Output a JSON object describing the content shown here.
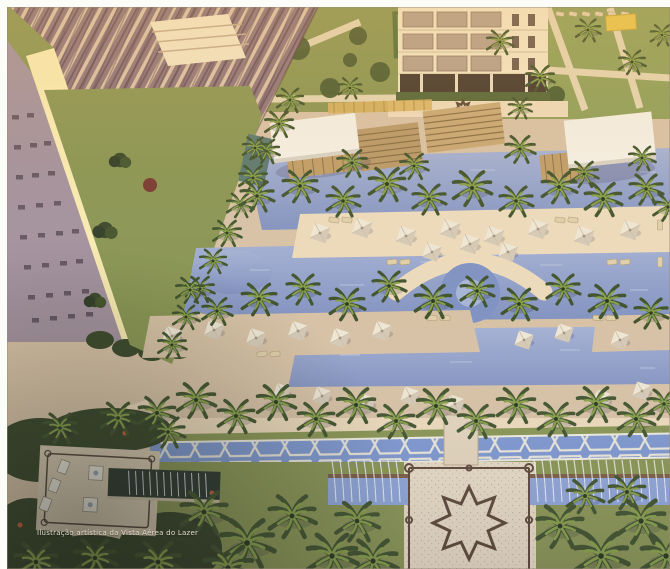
{
  "image": {
    "kind": "aerial architectural rendering of a residential leisure area at dusk",
    "caption": "Ilustração artística da Vista Aérea do Lazer"
  },
  "palette": {
    "frame": "#fcfcf9",
    "deck": "#d7c2a6",
    "deck_light": "#ecdabb",
    "water": "#94a2c8",
    "water_light": "#b6c0da",
    "canal": "#7e98cf",
    "dark_pool": "#2e3a30",
    "grass": "#8a9655",
    "grass_dark": "#55663a",
    "palm_dark": "#42552f",
    "palm_light": "#88a04b",
    "building_cream": "#f1e4c4",
    "building_lit": "#f7eab2",
    "facade_mauve": "#a3929e",
    "balcony_base": "#8f757d",
    "roof_white": "#f3efe5",
    "wood": "#c19e69",
    "umbrella": "#eee6d4",
    "star_outline": "#5d4a3a",
    "caption_color": "#e2dccd"
  },
  "scene": {
    "landmarks": [
      "residential tower",
      "apartment building",
      "sports court",
      "pool pavilions",
      "wood pergolas",
      "lagoon pools",
      "round pool",
      "palm groves",
      "pool umbrellas",
      "sun loungers",
      "moorish water channel",
      "fountain canals",
      "eight-point star plaza",
      "ornamental terrace",
      "reflecting pool",
      "shade canopy"
    ]
  }
}
